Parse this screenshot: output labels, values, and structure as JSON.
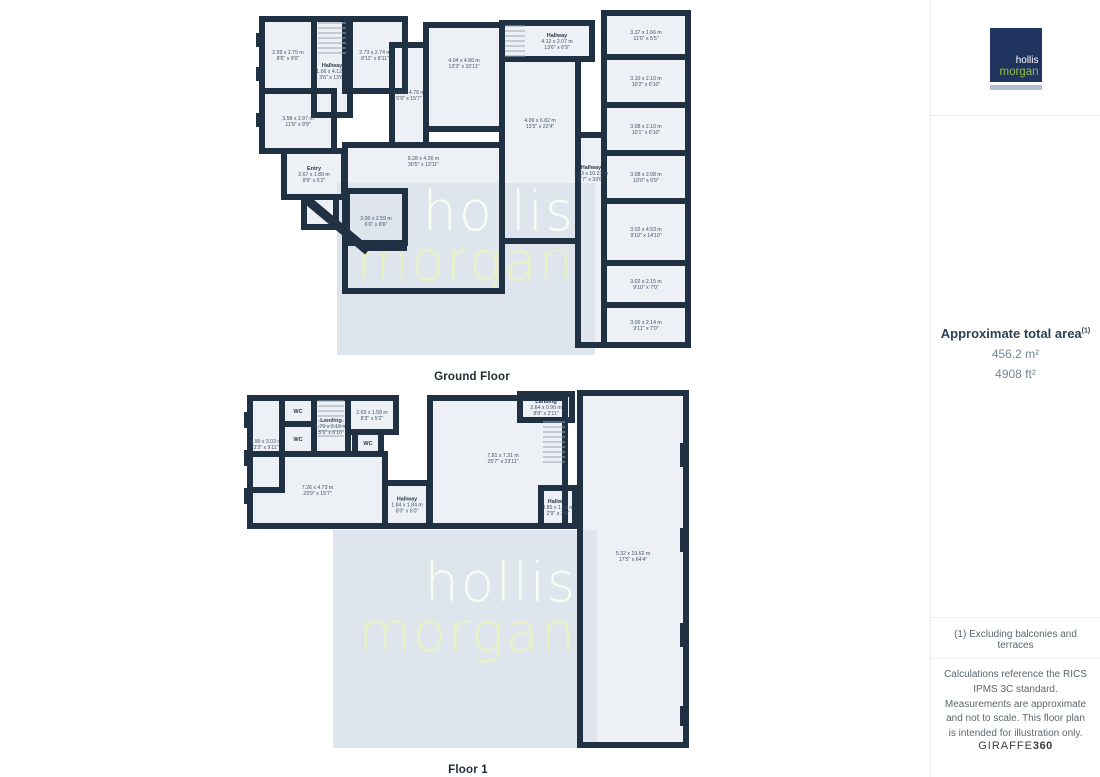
{
  "branding": {
    "line1": "hollis",
    "line2": "morgan"
  },
  "sidebar": {
    "area_title": "Approximate total area",
    "area_superscript": "(1)",
    "area_m2": "456.2 m²",
    "area_ft2": "4908 ft²",
    "footnote": "(1) Excluding balconies and terraces",
    "disclaimer": "Calculations reference the RICS IPMS 3C standard. Measurements are approximate and not to scale. This floor plan is intended for illustration only.",
    "brand_left": "GIRAFFE",
    "brand_right": "360"
  },
  "watermark": {
    "line1": "hollis",
    "line2": "morgan",
    "bg": "#dfe5ec",
    "color1": "#f9fcf2",
    "color2": "#e8f0c4"
  },
  "colors": {
    "wall": "#1f3143",
    "room_fill": "#edf0f4",
    "logo_navy": "#1f3560",
    "logo_green": "#8fbf3f",
    "logo_bar": "#b3c0d3"
  },
  "floors": [
    {
      "label": "Ground Floor",
      "canvas": {
        "left": 252,
        "top": 5,
        "width": 440,
        "height": 378
      },
      "watermark_rect": {
        "x": 85,
        "y": 178,
        "w": 258,
        "h": 172,
        "pad_top": 4
      },
      "rooms": [
        {
          "x": 10,
          "y": 14,
          "w": 52,
          "h": 72,
          "dims": "2.59 x 2.75 m",
          "ft": "8'6\" x 9'0\""
        },
        {
          "x": 62,
          "y": 14,
          "w": 36,
          "h": 96,
          "name": "Hallway",
          "dims": "1.06 x 4.12 m",
          "ft": "3'6\" x 13'6\"",
          "ly": 66
        },
        {
          "x": 10,
          "y": 86,
          "w": 72,
          "h": 60,
          "dims": "3.58 x 2.97 m",
          "ft": "11'9\" x 9'9\""
        },
        {
          "x": 93,
          "y": 14,
          "w": 60,
          "h": 72,
          "dims": "2.73 x 2.74 m",
          "ft": "8'11\" x 8'11\""
        },
        {
          "x": 140,
          "y": 40,
          "w": 34,
          "h": 100,
          "dims": "1.75 x 4.76 m",
          "ft": "5'9\" x 15'7\""
        },
        {
          "x": 174,
          "y": 20,
          "w": 76,
          "h": 104,
          "dims": "4.04 x 4.86 m",
          "ft": "13'3\" x 15'11\"",
          "ly": 58
        },
        {
          "x": 250,
          "y": 18,
          "w": 90,
          "h": 36,
          "name": "Hallway",
          "dims": "4.12 x 2.07 m",
          "ft": "13'6\" x 6'9\"",
          "lx": 305
        },
        {
          "x": 250,
          "y": 54,
          "w": 76,
          "h": 182,
          "dims": "4.09 x 6.82 m",
          "ft": "13'5\" x 22'4\"",
          "ly": 118
        },
        {
          "x": 93,
          "y": 140,
          "w": 157,
          "h": 146,
          "dims": "9.28 x 4.26 m",
          "ft": "30'5\" x 13'11\"",
          "ly": 156
        },
        {
          "x": 32,
          "y": 146,
          "w": 60,
          "h": 46,
          "name": "Entry",
          "dims": "2.67 x 1.89 m",
          "ft": "8'9\" x 6'2\""
        },
        {
          "x": 52,
          "y": 192,
          "w": 32,
          "h": 30,
          "name": "WC"
        },
        {
          "x": 95,
          "y": 186,
          "w": 58,
          "h": 52,
          "dims": "2.00 x 2.59 m",
          "ft": "6'6\" x 8'6\"",
          "ly": 216
        },
        {
          "x": 352,
          "y": 8,
          "w": 84,
          "h": 44,
          "dims": "3.37 x 1.66 m",
          "ft": "11'0\" x 5'5\""
        },
        {
          "x": 352,
          "y": 52,
          "w": 84,
          "h": 48,
          "dims": "3.10 x 2.10 m",
          "ft": "10'2\" x 6'10\""
        },
        {
          "x": 352,
          "y": 100,
          "w": 84,
          "h": 48,
          "dims": "3.08 x 2.10 m",
          "ft": "10'1\" x 6'10\""
        },
        {
          "x": 352,
          "y": 148,
          "w": 84,
          "h": 48,
          "dims": "3.08 x 2.08 m",
          "ft": "10'0\" x 6'9\""
        },
        {
          "x": 352,
          "y": 196,
          "w": 84,
          "h": 62,
          "dims": "3.02 x 4.53 m",
          "ft": "9'10\" x 14'10\""
        },
        {
          "x": 352,
          "y": 258,
          "w": 84,
          "h": 42,
          "dims": "3.02 x 2.15 m",
          "ft": "9'10\" x 7'0\""
        },
        {
          "x": 352,
          "y": 300,
          "w": 84,
          "h": 40,
          "dims": "3.06 x 2.14 m",
          "ft": "9'11\" x 7'0\""
        },
        {
          "x": 326,
          "y": 130,
          "w": 26,
          "h": 210,
          "name": "Hallway",
          "dims": "1.73 x 10.23 m",
          "ft": "5'7\" x 33'6\"",
          "lx": 339,
          "ly": 168
        }
      ],
      "stairs": [
        {
          "x": 66,
          "y": 18,
          "w": 28,
          "h": 34
        },
        {
          "x": 253,
          "y": 21,
          "w": 20,
          "h": 30
        }
      ],
      "piers": [
        {
          "x": 4,
          "y": 28,
          "w": 6,
          "h": 14
        },
        {
          "x": 4,
          "y": 62,
          "w": 6,
          "h": 14
        },
        {
          "x": 4,
          "y": 108,
          "w": 6,
          "h": 14
        }
      ],
      "walls": [
        {
          "x1": 54,
          "y1": 194,
          "x2": 116,
          "y2": 246,
          "sw": 9
        },
        {
          "x1": 112,
          "y1": 243,
          "x2": 155,
          "y2": 243,
          "sw": 6
        }
      ]
    },
    {
      "label": "Floor 1",
      "canvas": {
        "left": 243,
        "top": 388,
        "width": 450,
        "height": 388
      },
      "watermark_rect": {
        "x": 90,
        "y": 142,
        "w": 264,
        "h": 218,
        "pad_top": 28
      },
      "rooms": [
        {
          "x": 7,
          "y": 10,
          "w": 32,
          "h": 92,
          "dims": "0.99 x 3.03 m",
          "ft": "3'3\" x 9'11\""
        },
        {
          "x": 39,
          "y": 10,
          "w": 32,
          "h": 26,
          "name": "WC"
        },
        {
          "x": 39,
          "y": 36,
          "w": 32,
          "h": 30,
          "name": "WC"
        },
        {
          "x": 71,
          "y": 10,
          "w": 34,
          "h": 56,
          "name": "Landing",
          "dims": "1.76 x 2.10 m",
          "ft": "5'9\" x 6'10\"",
          "ly": 38
        },
        {
          "x": 105,
          "y": 10,
          "w": 48,
          "h": 34,
          "dims": "2.53 x 1.58 m",
          "ft": "8'3\" x 5'2\""
        },
        {
          "x": 112,
          "y": 44,
          "w": 26,
          "h": 22,
          "name": "WC"
        },
        {
          "x": 7,
          "y": 66,
          "w": 135,
          "h": 72,
          "dims": "7.26 x 4.73 m",
          "ft": "23'9\" x 15'7\""
        },
        {
          "x": 142,
          "y": 95,
          "w": 44,
          "h": 43,
          "name": "Hallway",
          "dims": "1.84 x 1.84 m",
          "ft": "6'0\" x 6'0\""
        },
        {
          "x": 187,
          "y": 10,
          "w": 135,
          "h": 128,
          "dims": "7.81 x 7.31 m",
          "ft": "25'7\" x 23'11\"",
          "lx": 260,
          "ly": 70
        },
        {
          "x": 277,
          "y": 6,
          "w": 52,
          "h": 26,
          "name": "Landing",
          "dims": "2.64 x 0.90 m",
          "ft": "8'8\" x 2'11\""
        },
        {
          "x": 298,
          "y": 100,
          "w": 34,
          "h": 38,
          "name": "Hallway",
          "dims": "0.85 x 1.04 m",
          "ft": "2'9\" x 3'5\""
        },
        {
          "x": 337,
          "y": 5,
          "w": 106,
          "h": 352,
          "dims": "5.32 x 19.62 m",
          "ft": "17'5\" x 64'4\"",
          "lx": 390,
          "ly": 168
        }
      ],
      "stairs": [
        {
          "x": 75,
          "y": 13,
          "w": 26,
          "h": 36
        },
        {
          "x": 300,
          "y": 34,
          "w": 22,
          "h": 40
        }
      ],
      "piers": [
        {
          "x": 1,
          "y": 24,
          "w": 6,
          "h": 16
        },
        {
          "x": 1,
          "y": 62,
          "w": 6,
          "h": 16
        },
        {
          "x": 1,
          "y": 100,
          "w": 6,
          "h": 16
        },
        {
          "x": 437,
          "y": 55,
          "w": 7,
          "h": 24
        },
        {
          "x": 437,
          "y": 140,
          "w": 7,
          "h": 24
        },
        {
          "x": 437,
          "y": 235,
          "w": 7,
          "h": 24
        },
        {
          "x": 437,
          "y": 318,
          "w": 7,
          "h": 20
        }
      ],
      "walls": []
    }
  ]
}
